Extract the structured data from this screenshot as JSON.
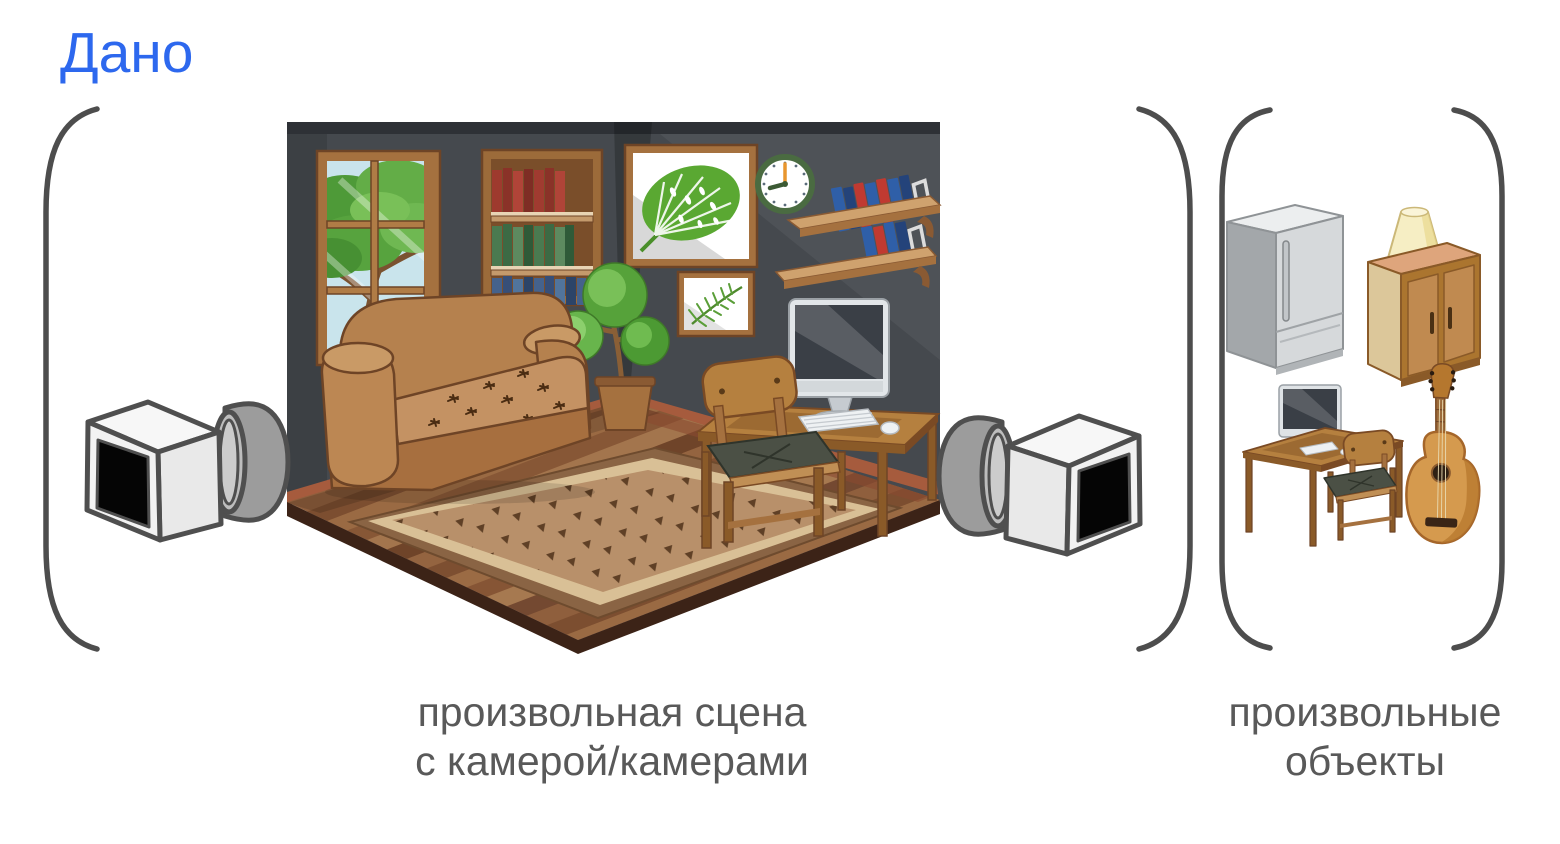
{
  "title": {
    "text": "Дано"
  },
  "groups": [
    {
      "name": "scene-with-cameras",
      "caption": [
        "произвольная сцена",
        "с камерой/камерами"
      ],
      "scene": {
        "type": "isometric-living-room",
        "furniture": [
          "window-with-tree-view",
          "wall-bookshelf-with-books",
          "monstera-painting",
          "fern-painting",
          "wall-clock",
          "wall-shelves-with-books",
          "sofa",
          "potted-plant",
          "computer-desk",
          "imac-computer",
          "wooden-chair",
          "patterned-rug"
        ],
        "cameras": [
          "video-camera-left",
          "video-camera-right"
        ],
        "camera_count": 2
      }
    },
    {
      "name": "arbitrary-objects",
      "caption": [
        "произвольные",
        "объекты"
      ],
      "objects": [
        "refrigerator",
        "cabinet-with-table-lamp",
        "computer-desk-with-chair",
        "acoustic-guitar"
      ]
    }
  ],
  "palette": {
    "title_blue": "#2d68ee",
    "caption_gray": "#595959",
    "bracket_gray": "#4d4d4d",
    "wall_dark": "#45494e",
    "baseboard_red": "#a65b3d",
    "wood_brown": "#b5803f",
    "sofa_brown": "#b5814e",
    "rug_tan": "#b8906a",
    "book_blue": "#2f5fa8",
    "book_red": "#c03a31",
    "plant_green": "#56a23a",
    "camera_gray": "#9c9c9c",
    "background": "#ffffff"
  }
}
